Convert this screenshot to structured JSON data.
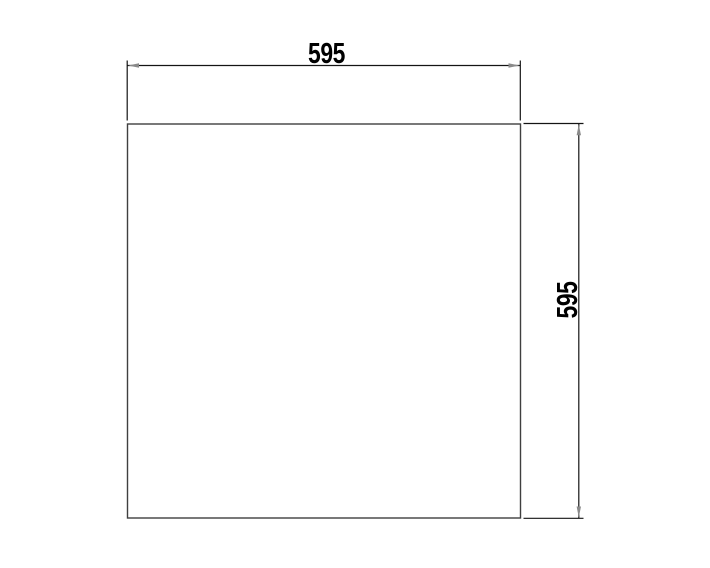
{
  "drawing": {
    "kind": "technical-dimension-drawing",
    "dimensions": {
      "width_label": "595",
      "height_label": "595"
    }
  },
  "colors": {
    "outline": "#3f3f3f",
    "dimension_line": "#141414",
    "arrow": "#8a8a8a",
    "label_text": "#000000",
    "background": "#ffffff"
  }
}
